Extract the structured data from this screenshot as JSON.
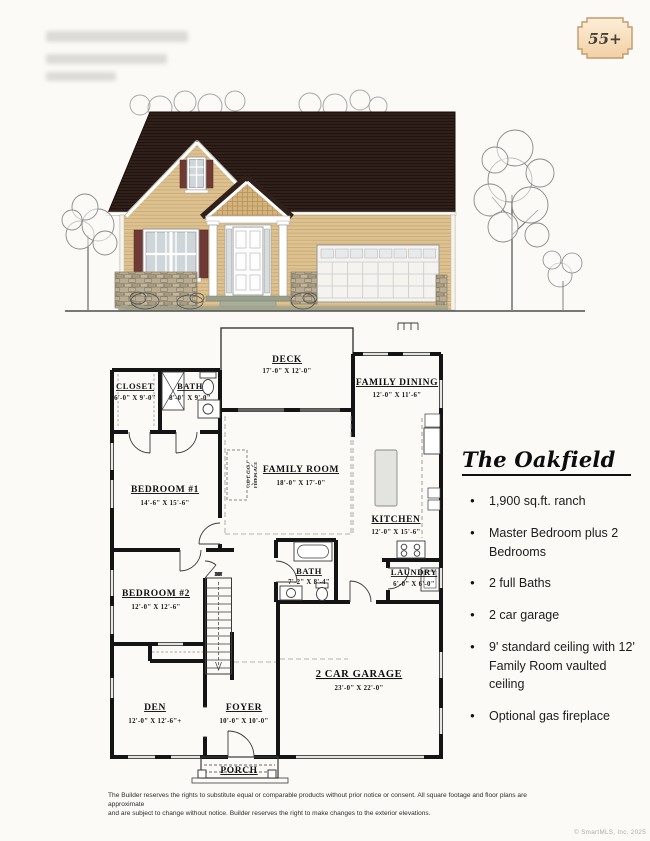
{
  "page": {
    "badge_label": "55+",
    "copyright": "© SmartMLS, Inc. 2025",
    "disclaimer": {
      "line1": "The Builder reserves the rights to substitute equal or comparable products without prior notice or consent. All square footage and floor plans are approximate",
      "line2": "and are subject to change without notice. Builder reserves the right to make changes to the exterior elevations."
    }
  },
  "info": {
    "title": "The Oakfield",
    "bullets": [
      "1,900 sq.ft. ranch",
      "Master Bedroom plus 2 Bedrooms",
      "2 full Baths",
      "2 car garage",
      "9' standard ceiling with 12' Family Room vaulted ceiling",
      "Optional gas fireplace"
    ]
  },
  "plan": {
    "stairs_label": "DN",
    "fireplace": {
      "line1": "OPT. GAS",
      "line2": "FIREPLACE"
    },
    "rooms": {
      "deck": {
        "name": "DECK",
        "dims": "17'-0\" X 12'-0\""
      },
      "closet": {
        "name": "CLOSET",
        "dims": "6'-0\" X 9'-0\""
      },
      "bath_top": {
        "name": "BATH",
        "dims": "8'-0\" X 9'-0\""
      },
      "family_dining": {
        "name": "FAMILY DINING",
        "dims": "12'-0\" X 11'-6\""
      },
      "family_room": {
        "name": "FAMILY ROOM",
        "dims": "18'-0\" X 17'-0\""
      },
      "bedroom1": {
        "name": "BEDROOM #1",
        "dims": "14'-6\" X 15'-6\""
      },
      "kitchen": {
        "name": "KITCHEN",
        "dims": "12'-0\" X 15'-6\""
      },
      "bath_mid": {
        "name": "BATH",
        "dims": "7'-2\" X 8'-4\""
      },
      "laundry": {
        "name": "LAUNDRY",
        "dims": "6'-0\" X 6'-0\""
      },
      "bedroom2": {
        "name": "BEDROOM #2",
        "dims": "12'-0\" X 12'-6\""
      },
      "garage": {
        "name": "2 CAR GARAGE",
        "dims": "23'-0\" X 22'-0\""
      },
      "den": {
        "name": "DEN",
        "dims": "12'-0\" X 12'-6\"+"
      },
      "foyer": {
        "name": "FOYER",
        "dims": "10'-0\" X 10'-0\""
      },
      "porch": {
        "name": "PORCH"
      }
    }
  },
  "colors": {
    "roof": "#30201a",
    "siding": "#ddc28f",
    "shutters": "#6e3a33",
    "stone": "#b9ac92",
    "badge_fill": "#f7dcb8",
    "badge_border": "#c49a6c"
  }
}
